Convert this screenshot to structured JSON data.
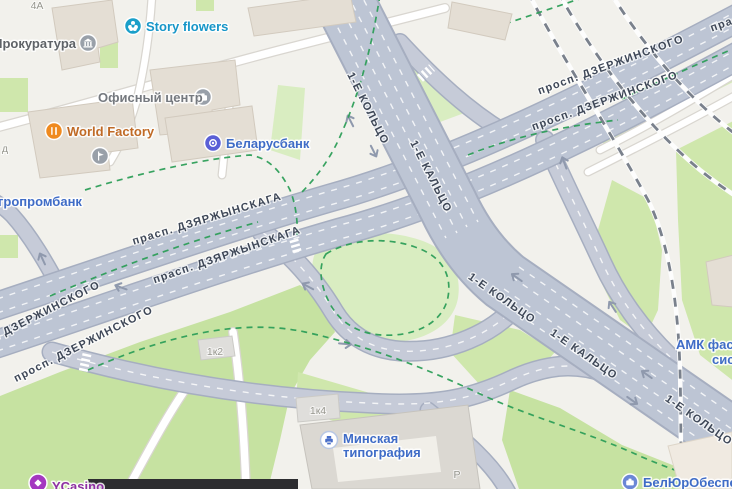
{
  "colors": {
    "background": "#f2f1ec",
    "green_area": "#cfe7ac",
    "green_light": "#d9edc1",
    "green_dark": "#c6e2a1",
    "road_fill": "#bdc5d4",
    "road_casing": "#a6aec0",
    "ramp_fill": "#c6cbd8",
    "minor_road": "#ffffff",
    "building": "#e4ded4",
    "railway": "#7a818c",
    "bike_path": "#2d9e58",
    "road_label": "#3e4757",
    "poi_blue": "#3f6cc7"
  },
  "road_labels": [
    {
      "text": "1-Е КОЛЬЦО"
    },
    {
      "text": "1-Е КАЛЬЦО"
    },
    {
      "text": "1-Е КОЛЬЦО"
    },
    {
      "text": "1-Е КАЛЬЦО"
    },
    {
      "text": "1-Е КОЛЬЦО"
    },
    {
      "text": "просп. ДЗЕРЖИНСКОГО"
    },
    {
      "text": "просп. ДЗЕРЖИНСКОГО"
    },
    {
      "text": "прасп. ДЗЯРЖЫНСКАГА"
    },
    {
      "text": "прасп. ДЗЯРЖЫНСКАГА"
    },
    {
      "text": "прасп. ДЗЯРЖЫНСКАГА"
    },
    {
      "text": "просп. ДЗЕРЖИНСКОГО"
    },
    {
      "text": "просп. ДЗЕРЖИНСКОГО"
    }
  ],
  "poi": {
    "story_flowers": {
      "name": "Story flowers",
      "color": "#1796c8"
    },
    "prokuratura": {
      "name": "Прокуратура",
      "color": "#5f6368"
    },
    "office_center": {
      "name": "Офисный центр",
      "color": "#75797f"
    },
    "world_factory": {
      "name": "World Factory",
      "color": "#c06a25"
    },
    "belarusbank": {
      "name": "Беларусбанк",
      "color": "#3f6cc7"
    },
    "agroprombank": {
      "name": "гропромбанк",
      "color": "#3f6cc7"
    },
    "amk": {
      "line1": "АМК фаса",
      "line2": "сис",
      "color": "#3f6cc7"
    },
    "minsk_printing": {
      "line1": "Минская",
      "line2": "типография",
      "color": "#3f6cc7"
    },
    "beluro": {
      "name": "БелЮрОбеспеч",
      "color": "#3f6cc7"
    },
    "ycasino": {
      "name": "YCasino",
      "color": "#8e2fa3"
    }
  },
  "building_labels": [
    {
      "text": "4А"
    },
    {
      "text": "д"
    },
    {
      "text": "1к2"
    },
    {
      "text": "1к4"
    },
    {
      "text": "Р"
    }
  ]
}
